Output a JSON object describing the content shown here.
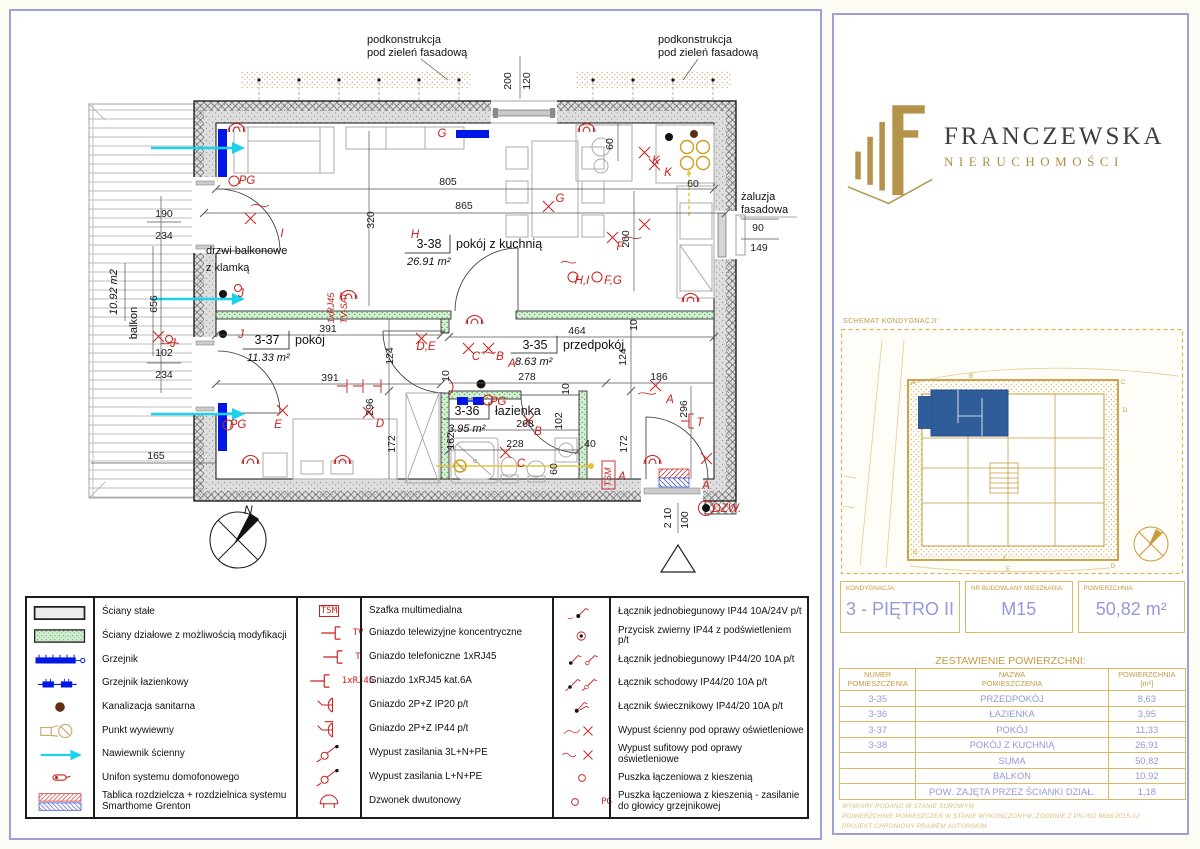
{
  "brand": {
    "name": "FRANCZEWSKA",
    "subtitle": "NIERUCHOMOŚCI",
    "gold": "#b6934b",
    "dark": "#3e3e40"
  },
  "schematic": {
    "title": "SCHEMAT KONDYGNACJI:",
    "letters": [
      "A",
      "B",
      "C",
      "D",
      "G",
      "F",
      "E",
      "D"
    ],
    "highlight_color": "#2e5d99"
  },
  "unit_info": {
    "fields": [
      {
        "label": "KONDYGNACJA:",
        "value": "3 - PIĘTRO II"
      },
      {
        "label": "NR BUDOWLANY MIESZKANIA:",
        "value": "M15"
      },
      {
        "label": "POWIERZCHNIA:",
        "value": "50,82 m²"
      }
    ]
  },
  "area_table": {
    "title": "ZESTAWIENIE POWIERZCHNI:",
    "headers": [
      "NUMER\nPOMIESZCZENIA",
      "NAZWA\nPOMIESZCZENIA",
      "POWIERZCHNIA\n[m²]"
    ],
    "rows": [
      {
        "num": "3-35",
        "name": "PRZEDPOKÓJ",
        "area": "8,63"
      },
      {
        "num": "3-36",
        "name": "ŁAZIENKA",
        "area": "3,95"
      },
      {
        "num": "3-37",
        "name": "POKÓJ",
        "area": "11,33"
      },
      {
        "num": "3-38",
        "name": "POKÓJ Z KUCHNIĄ",
        "area": "26,91"
      },
      {
        "num": "",
        "name": "SUMA",
        "area": "50,82"
      },
      {
        "num": "",
        "name": "BALKON",
        "area": "10,92"
      },
      {
        "num": "",
        "name": "POW. ZAJĘTA PRZEZ ŚCIANKI DZIAŁ.",
        "area": "1,18"
      }
    ]
  },
  "disclaimer": [
    "WYMIARY PODANO W STANIE SUROWYM",
    "POWIERZCHNIE POMIESZCZEŃ W STANIE WYKOŃCZONYM, ZGODNIE Z PN-ISO 9836:2015-12",
    "PROJEKT CHRONIONY PRAWEM AUTORSKIM"
  ],
  "legend": {
    "col1": [
      {
        "glyph": "wall-solid",
        "label": "Ściany stałe"
      },
      {
        "glyph": "wall-mod",
        "label": "Ściany działowe z możliwością modyfikacji"
      },
      {
        "glyph": "radiator",
        "label": "Grzejnik"
      },
      {
        "glyph": "radiator-bath",
        "label": "Grzejnik łazienkowy"
      },
      {
        "glyph": "sewer",
        "label": "Kanalizacja sanitarna"
      },
      {
        "glyph": "vent",
        "label": "Punkt wywiewny"
      },
      {
        "glyph": "air-inlet",
        "label": "Nawiewnik ścienny"
      },
      {
        "glyph": "intercom",
        "label": "Unifon systemu domofonowego"
      },
      {
        "glyph": "dist-board",
        "label": "Tablica rozdzielcza + rozdzielnica systemu Smarthome Grenton"
      }
    ],
    "col2": [
      {
        "sym_text": "TSM",
        "boxed": true,
        "label": "Szafka multimedialna"
      },
      {
        "glyph": "jack",
        "sym_text": "TV",
        "label": "Gniazdo telewizyjne koncentryczne"
      },
      {
        "glyph": "jack",
        "sym_text": "T",
        "label": "Gniazdo telefoniczne 1xRJ45"
      },
      {
        "glyph": "jack",
        "sym_text": "1xRJ45",
        "label": "Gniazdo 1xRJ45 kat.6A"
      },
      {
        "glyph": "socket",
        "label": "Gniazdo 2P+Z IP20 p/t"
      },
      {
        "glyph": "socket-ip44",
        "label": "Gniazdo 2P+Z IP44 p/t"
      },
      {
        "glyph": "power-outlet",
        "label": "Wypust zasilania 3L+N+PE"
      },
      {
        "glyph": "power-outlet",
        "label": "Wypust zasilania L+N+PE"
      },
      {
        "glyph": "bell",
        "label": "Dzwonek dwutonowy"
      }
    ],
    "col3": [
      {
        "glyph": "switch-1pole",
        "label": "Łącznik jednobiegunowy IP44 10A/24V p/t"
      },
      {
        "glyph": "push-button",
        "label": "Przycisk zwierny IP44 z podświetleniem p/t"
      },
      {
        "glyph": "switch-1pole-2",
        "label": "Łącznik jednobiegunowy IP44/20 10A p/t"
      },
      {
        "glyph": "switch-stair",
        "label": "Łącznik schodowy IP44/20 10A p/t"
      },
      {
        "glyph": "switch-chandelier",
        "label": "Łącznik świecznikowy IP44/20 10A p/t"
      },
      {
        "glyph": "wall-light",
        "label": "Wypust ścienny pod oprawy oświetleniowe"
      },
      {
        "glyph": "ceiling-light",
        "label": "Wypust sufitowy pod oprawy oświetleniowe"
      },
      {
        "glyph": "junction-box",
        "label": "Puszka łączeniowa z kieszenią"
      },
      {
        "glyph": "junction-box",
        "sym_text": "PG",
        "label": "Puszka łączeniowa z kieszenią - zasilanie do głowicy grzejnikowej"
      }
    ]
  },
  "plan": {
    "rooms": [
      {
        "number": "3-38",
        "name": "pokój z kuchnią",
        "area": "26.91 m²"
      },
      {
        "number": "3-37",
        "name": "pokój",
        "area": "11.33 m²"
      },
      {
        "number": "3-35",
        "name": "przedpokój",
        "area": "8.63 m²"
      },
      {
        "number": "3-36",
        "name": "łazienka",
        "area": "3.95 m²"
      }
    ],
    "notes": {
      "podkonstrukcja_line1": "podkonstrukcja",
      "podkonstrukcja_line2": "pod zieleń fasadową",
      "balcony_door_line1": "drzwi balkonowe",
      "balcony_door_line2": "z klamką",
      "zaluzja_line1": "żaluzja",
      "zaluzja_line2": "fasadowa",
      "balcony_area": "10.92 m2",
      "balcony_label": "balkon",
      "north": "N"
    },
    "dims": [
      "200",
      "120",
      "805",
      "865",
      "320",
      "60",
      "60",
      "260",
      "90",
      "149",
      "190",
      "234",
      "656",
      "102",
      "234",
      "165",
      "391",
      "391",
      "124",
      "464",
      "10",
      "124",
      "278",
      "10",
      "186",
      "296",
      "268",
      "102",
      "228",
      "40",
      "162",
      "60",
      "172",
      "172",
      "296",
      "100",
      "2 10",
      "10"
    ],
    "circuits": [
      "PG",
      "G",
      "I",
      "H",
      "G",
      "K",
      "K",
      "F",
      "H,I",
      "F,G",
      "J",
      "J",
      "J",
      "1xRJ45",
      "TV-SAT",
      "D,E",
      "C",
      "B",
      "A",
      "A",
      "PG",
      "PG",
      "E",
      "D",
      "C",
      "B",
      "A",
      "T",
      "TSM",
      "DZW.",
      "A"
    ]
  }
}
